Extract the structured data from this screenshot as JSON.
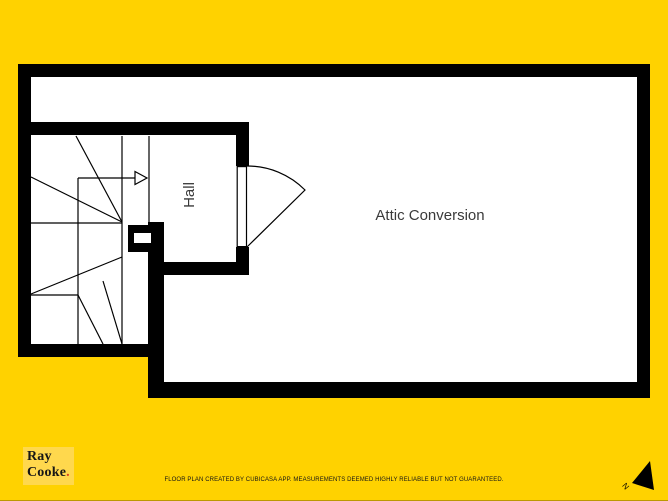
{
  "page": {
    "background_color": "#FFD200"
  },
  "floor_plan": {
    "wall_color": "#000000",
    "floor_color": "#FFFFFF",
    "attic_label": "Attic Conversion",
    "hall_label": "Hall",
    "stair_direction": "arrow-right",
    "rooms": [
      {
        "label": "Attic Conversion"
      },
      {
        "label": "Hall"
      }
    ]
  },
  "branding": {
    "name_line1": "Ray",
    "name_line2": "Cooke",
    "period": ".",
    "box_color": "#FFD84D",
    "text_color": "#161616",
    "period_color": "#D8401F"
  },
  "compass": {
    "north_label": "N"
  },
  "footer": {
    "disclaimer": "FLOOR PLAN CREATED BY CUBICASA APP. MEASUREMENTS DEEMED HIGHLY RELIABLE BUT NOT GUARANTEED."
  }
}
